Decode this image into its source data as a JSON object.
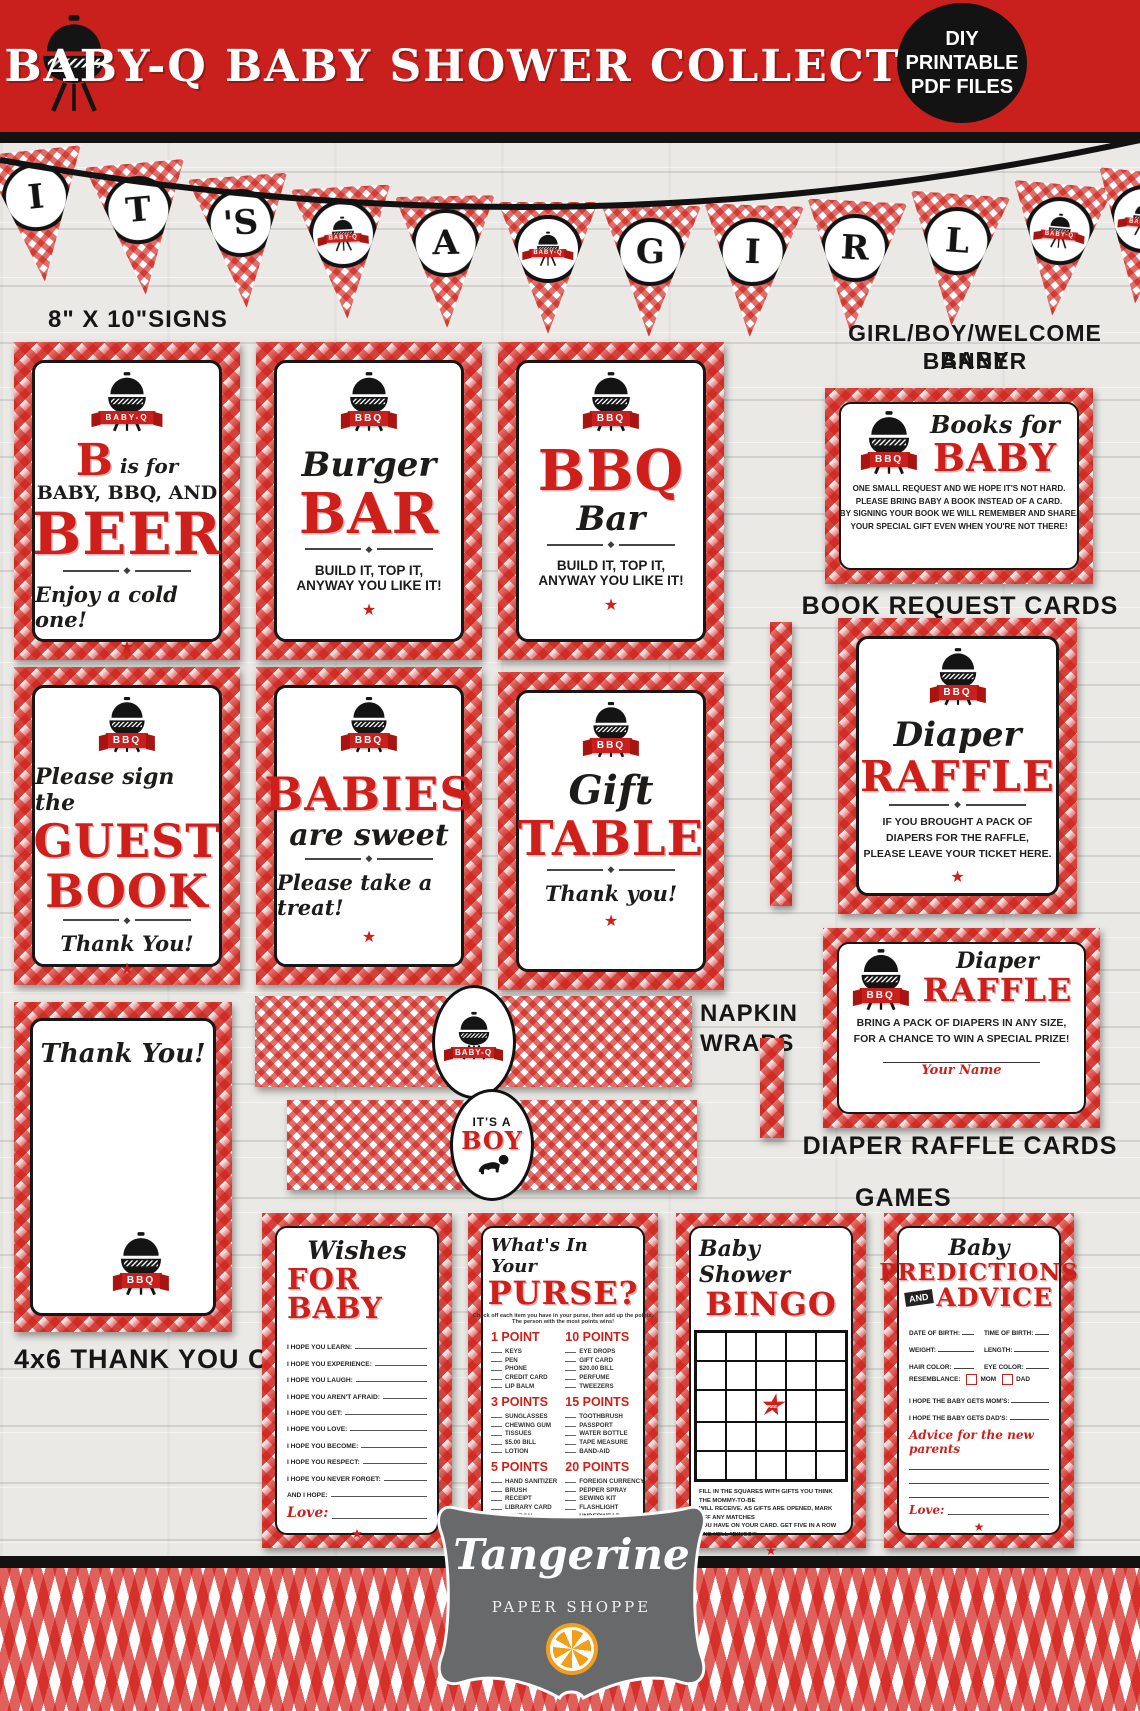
{
  "header": {
    "title": "BABY-Q BABY SHOWER COLLECTION",
    "badge": [
      "DIY",
      "PRINTABLE",
      "PDF FILES"
    ]
  },
  "pennant": {
    "letters": [
      "I",
      "T",
      "'S",
      "",
      "A",
      "",
      "G",
      "I",
      "R",
      "L",
      "",
      ""
    ],
    "badge_text": "BABY-Q"
  },
  "labels": {
    "signs": "8\" X 10\"SIGNS",
    "banner1": "GIRL/BOY/WELCOME BABY",
    "banner2": "BANNER",
    "book_request": "BOOK REQUEST CARDS",
    "napkin1": "NAPKIN",
    "napkin2": "WRAPS",
    "diaper_cards": "DIAPER RAFFLE CARDS",
    "games": "GAMES",
    "thankyou": "4x6 THANK YOU CARDS"
  },
  "signs": {
    "beer": {
      "ribbon": "BABY-Q",
      "initial": "B",
      "is_for": "is for",
      "line2": "BABY, BBQ, AND",
      "big": "BEER",
      "tagline": "Enjoy a cold one!"
    },
    "burger": {
      "ribbon": "BBQ",
      "script": "Burger",
      "big": "BAR",
      "tag1": "BUILD IT, TOP IT,",
      "tag2": "ANYWAY YOU LIKE IT!"
    },
    "bbq": {
      "ribbon": "BBQ",
      "big": "BBQ",
      "script": "Bar",
      "tag1": "BUILD IT, TOP IT,",
      "tag2": "ANYWAY YOU LIKE IT!"
    },
    "guest": {
      "ribbon": "BBQ",
      "script": "Please sign the",
      "big1": "GUEST",
      "big2": "BOOK",
      "tagline": "Thank You!"
    },
    "babies": {
      "ribbon": "BBQ",
      "big": "BABIES",
      "script": "are sweet",
      "tagline": "Please take a treat!"
    },
    "gift": {
      "ribbon": "BBQ",
      "script": "Gift",
      "big": "TABLE",
      "tagline": "Thank you!"
    }
  },
  "books": {
    "ribbon": "BBQ",
    "script": "Books for",
    "big": "BABY",
    "lines": [
      "ONE SMALL REQUEST AND WE HOPE IT'S NOT HARD.",
      "PLEASE BRING BABY A BOOK INSTEAD OF A CARD.",
      "BY SIGNING YOUR BOOK WE WILL REMEMBER AND SHARE,",
      "YOUR SPECIAL GIFT EVEN WHEN YOU'RE NOT THERE!"
    ]
  },
  "diaper_sign": {
    "ribbon": "BBQ",
    "script": "Diaper",
    "big": "RAFFLE",
    "lines": [
      "IF YOU BROUGHT A PACK OF",
      "DIAPERS FOR THE RAFFLE,",
      "PLEASE LEAVE YOUR TICKET HERE."
    ]
  },
  "diaper_card": {
    "ribbon": "BBQ",
    "script": "Diaper",
    "big": "RAFFLE",
    "lines": [
      "BRING A PACK OF DIAPERS IN ANY SIZE,",
      "FOR A CHANCE TO WIN A SPECIAL PRIZE!"
    ],
    "signature": "Your Name"
  },
  "thankyou_card": {
    "script": "Thank You!",
    "ribbon": "BBQ"
  },
  "napkin": {
    "wrap1": "BABY-Q",
    "wrap2_small": "IT'S A",
    "wrap2_big": "BOY"
  },
  "games": {
    "wishes": {
      "script": "Wishes",
      "big": "FOR BABY",
      "lines": [
        "I HOPE YOU LEARN:",
        "I HOPE YOU EXPERIENCE:",
        "I HOPE YOU LAUGH:",
        "I HOPE YOU AREN'T AFRAID:",
        "I HOPE YOU GET:",
        "I HOPE YOU LOVE:",
        "I HOPE YOU BECOME:",
        "I HOPE YOU RESPECT:",
        "I HOPE YOU NEVER FORGET:",
        "AND I HOPE:"
      ],
      "love": "Love:"
    },
    "purse": {
      "script": "What's In Your",
      "big": "PURSE?",
      "intro1": "Check off each item you have in your purse, then add up the points.",
      "intro2": "The person with the most points wins!",
      "groups": [
        {
          "heading": "1 POINT",
          "items": [
            "KEYS",
            "PEN",
            "PHONE",
            "CREDIT CARD",
            "LIP BALM"
          ]
        },
        {
          "heading": "3 POINTS",
          "items": [
            "SUNGLASSES",
            "CHEWING GUM",
            "TISSUES",
            "$5.00 BILL",
            "LOTION"
          ]
        },
        {
          "heading": "5 POINTS",
          "items": [
            "HAND SANITIZER",
            "BRUSH",
            "RECEIPT",
            "LIBRARY CARD",
            "COUPON"
          ]
        },
        {
          "heading": "10 POINTS",
          "items": [
            "EYE DROPS",
            "GIFT CARD",
            "$20.00 BILL",
            "PERFUME",
            "TWEEZERS"
          ]
        },
        {
          "heading": "15 POINTS",
          "items": [
            "TOOTHBRUSH",
            "PASSPORT",
            "WATER BOTTLE",
            "TAPE MEASURE",
            "BAND-AID"
          ]
        },
        {
          "heading": "20 POINTS",
          "items": [
            "FOREIGN CURRENCY",
            "PEPPER SPRAY",
            "SEWING KIT",
            "FLASHLIGHT",
            "UNDERWEAR"
          ]
        }
      ],
      "total": "TOTAL:"
    },
    "bingo": {
      "script": "Baby Shower",
      "big": "BINGO",
      "free": "FREE",
      "footer": [
        "FILL IN THE SQUARES WITH GIFTS YOU THINK THE MOMMY-TO-BE",
        "WILL RECEIVE. AS GIFTS ARE OPENED, MARK OFF ANY MATCHES",
        "YOU HAVE ON YOUR CARD. GET FIVE IN A ROW AND YELL \"BINGO!\""
      ]
    },
    "predictions": {
      "script": "Baby",
      "big1": "PREDICTIONS",
      "and": "AND",
      "big2": "ADVICE",
      "fields": [
        "DATE OF BIRTH:",
        "TIME OF BIRTH:",
        "WEIGHT:",
        "LENGTH:",
        "HAIR COLOR:",
        "EYE COLOR:"
      ],
      "resemblance": "RESEMBLANCE:",
      "mom": "MOM",
      "dad": "DAD",
      "hopes": [
        "I HOPE THE BABY GETS MOM'S:",
        "I HOPE THE BABY GETS DAD'S:"
      ],
      "advice": "Advice for the new parents",
      "love": "Love:"
    }
  },
  "logo": {
    "name": "Tangerine",
    "subtitle": "PAPER SHOPPE"
  },
  "colors": {
    "brand_red": "#c9201d",
    "gingham_red": "#cd2018",
    "accent_black": "#151413",
    "logo_gray": "#67696b",
    "orange": "#f29e18"
  }
}
